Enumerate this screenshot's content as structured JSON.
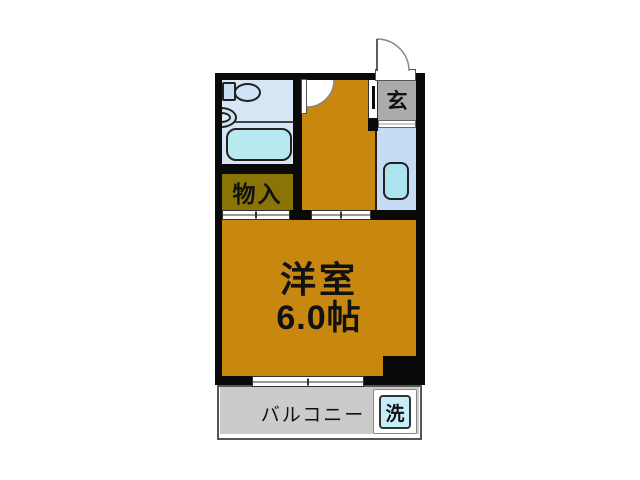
{
  "rooms": {
    "entrance": {
      "label": "玄",
      "floor_color": "#ababab"
    },
    "bathroom": {
      "floor_color": "#d6e6f5"
    },
    "storage": {
      "label": "物入",
      "floor_color": "#8a7406"
    },
    "hallway": {
      "floor_color": "#c8870e"
    },
    "kitchen": {
      "floor_color": "#c6dcf2"
    },
    "main_room": {
      "label": "洋室",
      "size": "6.0帖",
      "floor_color": "#c8870e"
    },
    "balcony": {
      "label": "バルコニー",
      "floor_color": "#cbcbcb"
    },
    "laundry": {
      "label": "洗",
      "fill_color": "#c6eef8"
    }
  },
  "palette": {
    "wall": "#0a0a0a",
    "background": "#ffffff",
    "bathtub": "#b8e9f1",
    "kitchen_sink": "#abe4ef",
    "fixture_fill": "#cfe4f6",
    "entrance_gray": "#ababab",
    "balcony_gray": "#cbcbcb"
  },
  "fixtures": [
    "entrance-door",
    "bathroom-door",
    "toilet",
    "wash-basin",
    "bathtub",
    "kitchen-sink",
    "storage-sliding-door",
    "room-sliding-door",
    "balcony-window",
    "washing-machine-space"
  ]
}
